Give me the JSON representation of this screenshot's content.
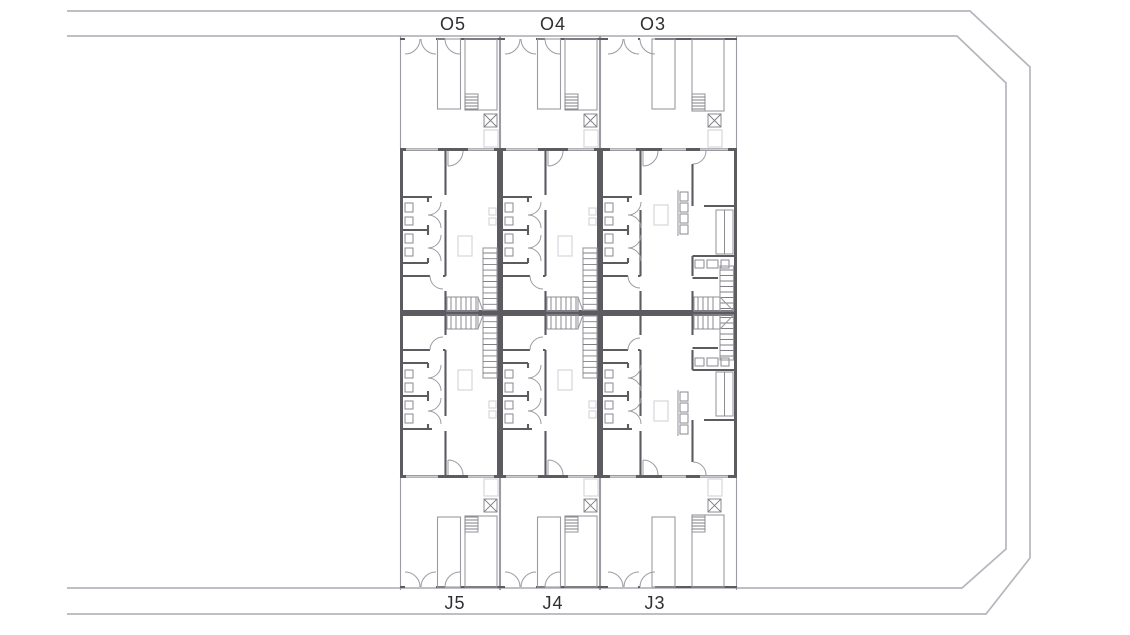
{
  "drawing": {
    "kind": "residential site floor plan",
    "units": {
      "top": [
        {
          "label": "O5"
        },
        {
          "label": "O4"
        },
        {
          "label": "O3"
        }
      ],
      "bottom": [
        {
          "label": "J5"
        },
        {
          "label": "J4"
        },
        {
          "label": "J3"
        }
      ]
    }
  },
  "colors": {
    "background": "#ffffff",
    "wall": "#5b5b60",
    "thin": "#9b9ba1",
    "road": "#b5b5bc",
    "hatch": "#7f7f85",
    "fixture": "#8a8a90",
    "faint": "#d7d7db",
    "label": "#2f2f33"
  }
}
